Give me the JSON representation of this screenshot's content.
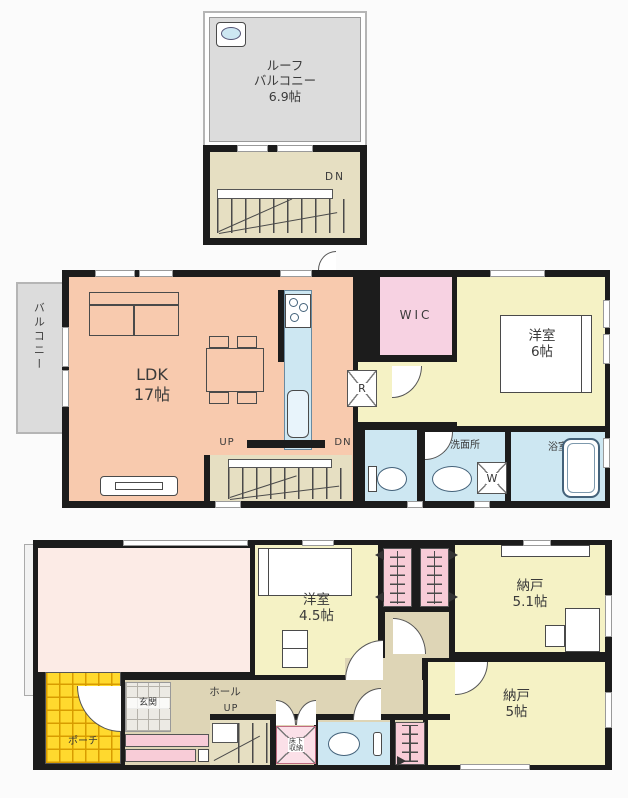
{
  "colors": {
    "wall": "#1c1c1c",
    "ldk": "#f8caae",
    "room": "#f5f2c5",
    "wic": "#f7d2e2",
    "water": "#cde7f2",
    "stairs": "#e6dfc2",
    "hall": "#ded5b6",
    "porch": "#ffd92e",
    "porch_line": "#d89c00",
    "balcony": "#dcdcdc",
    "open_room": "#fcebe6",
    "closet": "#f8ccd7",
    "fixture": "#ffffff",
    "canvas": "#fbfbfb"
  },
  "roof": {
    "balcony_label": "ルーフ\nバルコニー\n6.9帖",
    "dn_label": "DN"
  },
  "second_floor": {
    "balcony_label": "バルコニー",
    "ldk_label": "LDK\n17帖",
    "up_label": "UP",
    "dn_label": "DN",
    "wic_label": "WIC",
    "bedroom_label": "洋室\n6帖",
    "washroom_label": "洗面所",
    "bath_label": "浴室",
    "fridge_label": "R",
    "washer_label": "W"
  },
  "first_floor": {
    "bedroom_label": "洋室\n4.5帖",
    "storage1_label": "納戸\n5.1帖",
    "storage2_label": "納戸\n5帖",
    "hall_label": "ホール",
    "up_label": "UP",
    "entrance_label": "玄関",
    "porch_label": "ポーチ",
    "underfloor_label": "床下\n収納"
  }
}
